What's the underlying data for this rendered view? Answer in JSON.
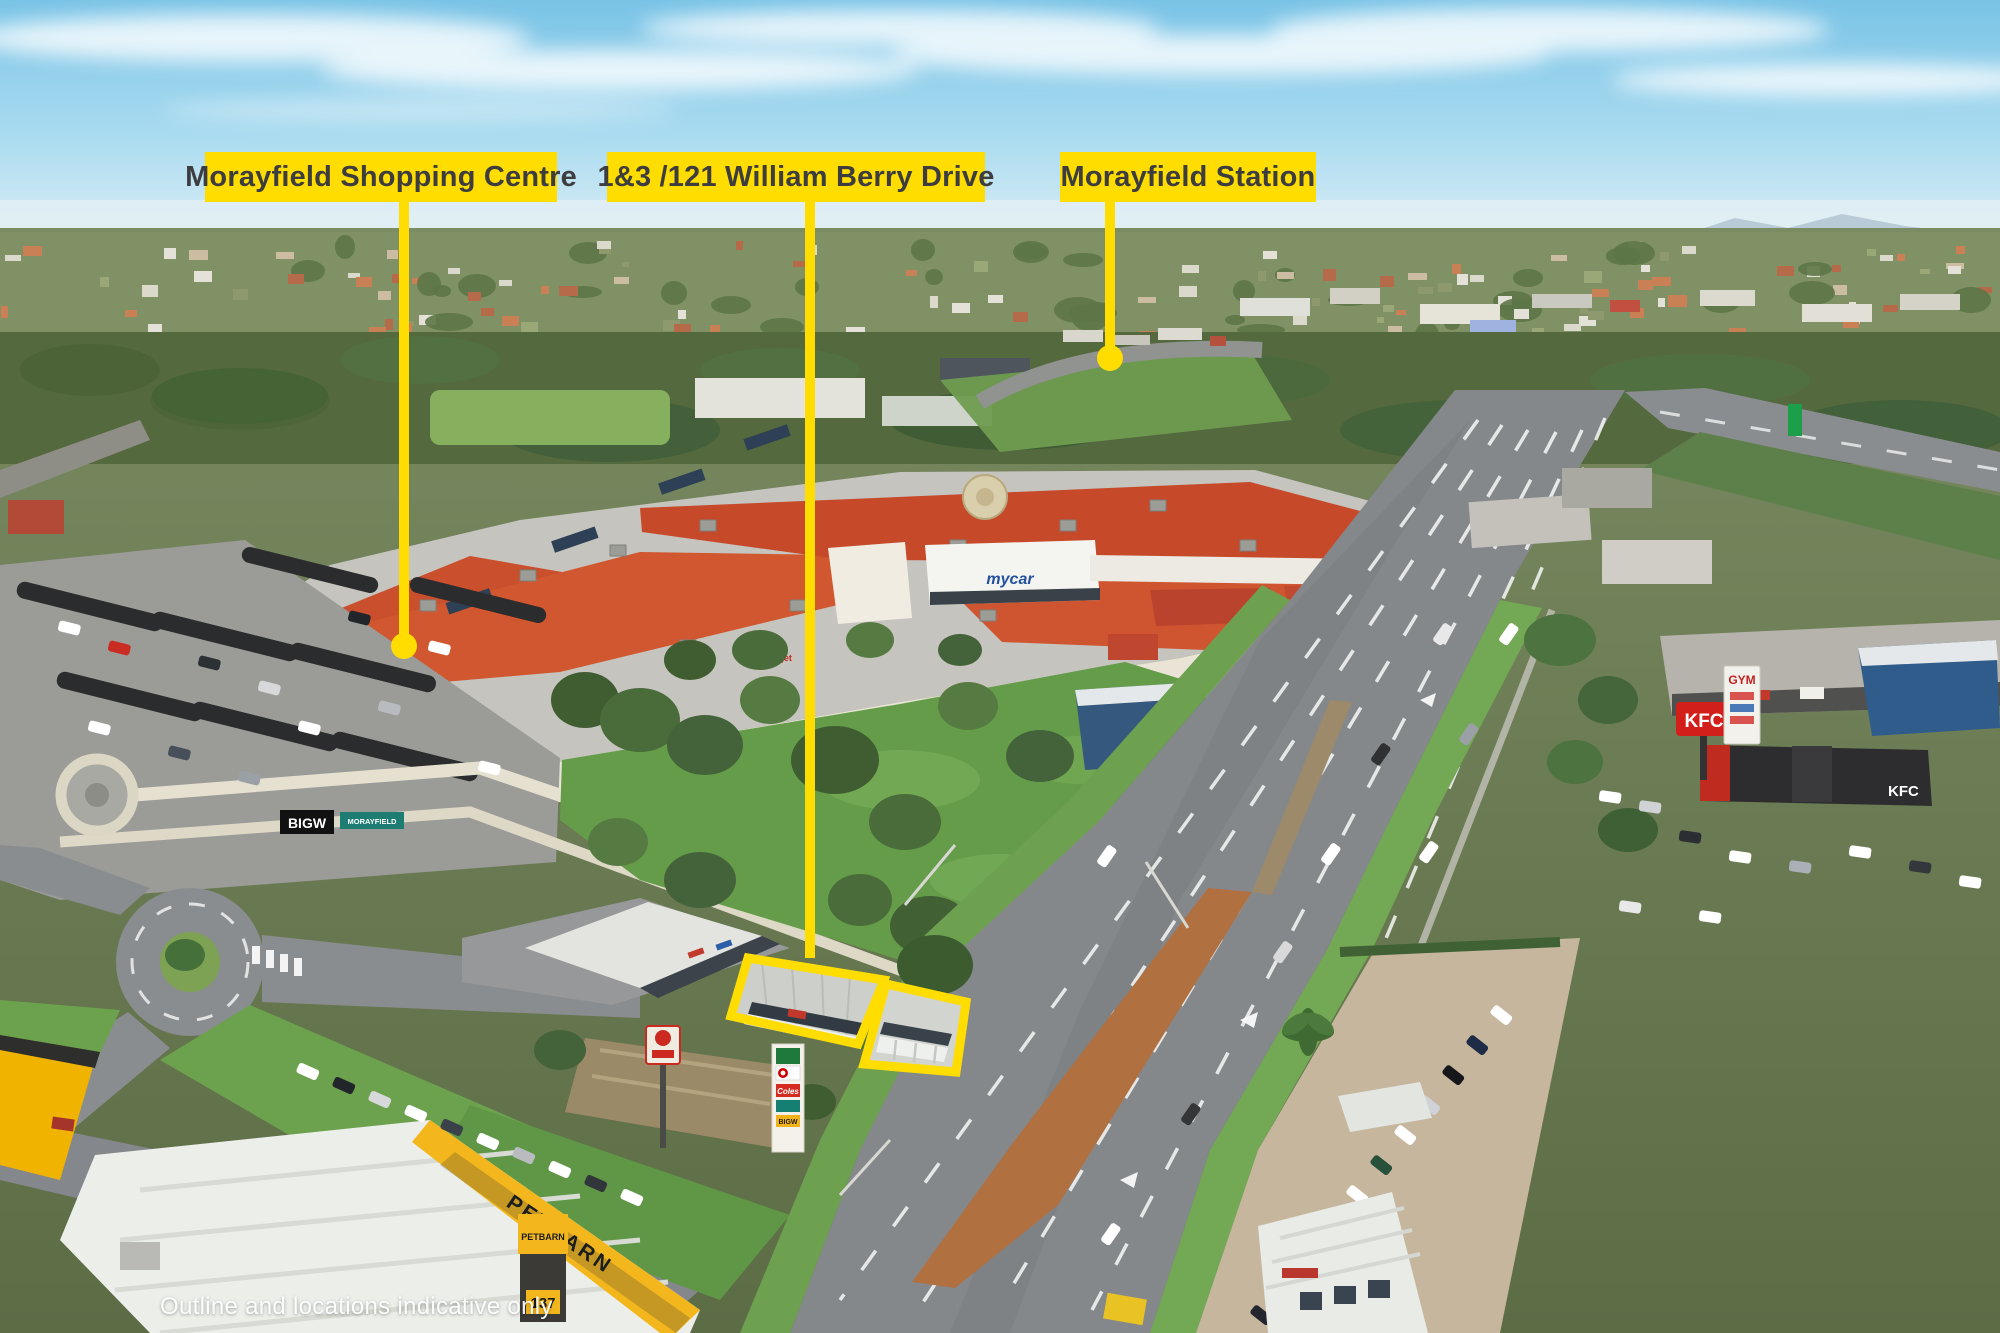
{
  "annotations": {
    "accent_color": "#ffdd00",
    "label_text_color": "#3d3d40",
    "labels": [
      {
        "id": "shopping-centre",
        "text": "Morayfield Shopping Centre",
        "x": 205,
        "y": 152,
        "w": 352,
        "h": 50,
        "line_x": 404,
        "line_y2": 638,
        "dot": true
      },
      {
        "id": "subject-address",
        "text": "1&3 /121 William Berry Drive",
        "x": 607,
        "y": 152,
        "w": 378,
        "h": 50,
        "line_x": 810,
        "line_y2": 958,
        "dot": false
      },
      {
        "id": "station",
        "text": "Morayfield Station",
        "x": 1060,
        "y": 152,
        "w": 256,
        "h": 50,
        "line_x": 1110,
        "line_y2": 350,
        "dot": true
      }
    ],
    "outline_polygons": [
      "748,958 884,980 858,1044 731,1016",
      "886,984 966,1002 956,1072 864,1064"
    ],
    "disclaimer": {
      "text": "Outline and locations indicative only",
      "x": 160,
      "y": 1293
    }
  },
  "scene": {
    "signs": {
      "petbarn": "PETBARN",
      "number_137": "137",
      "bigw": "BIGW",
      "morayfield": "MORAYFIELD",
      "kfc": "KFC",
      "mycar": "mycar",
      "jaycar": "Jaycar",
      "gym": "GYM",
      "coles": "Coles",
      "target": "Target"
    }
  }
}
